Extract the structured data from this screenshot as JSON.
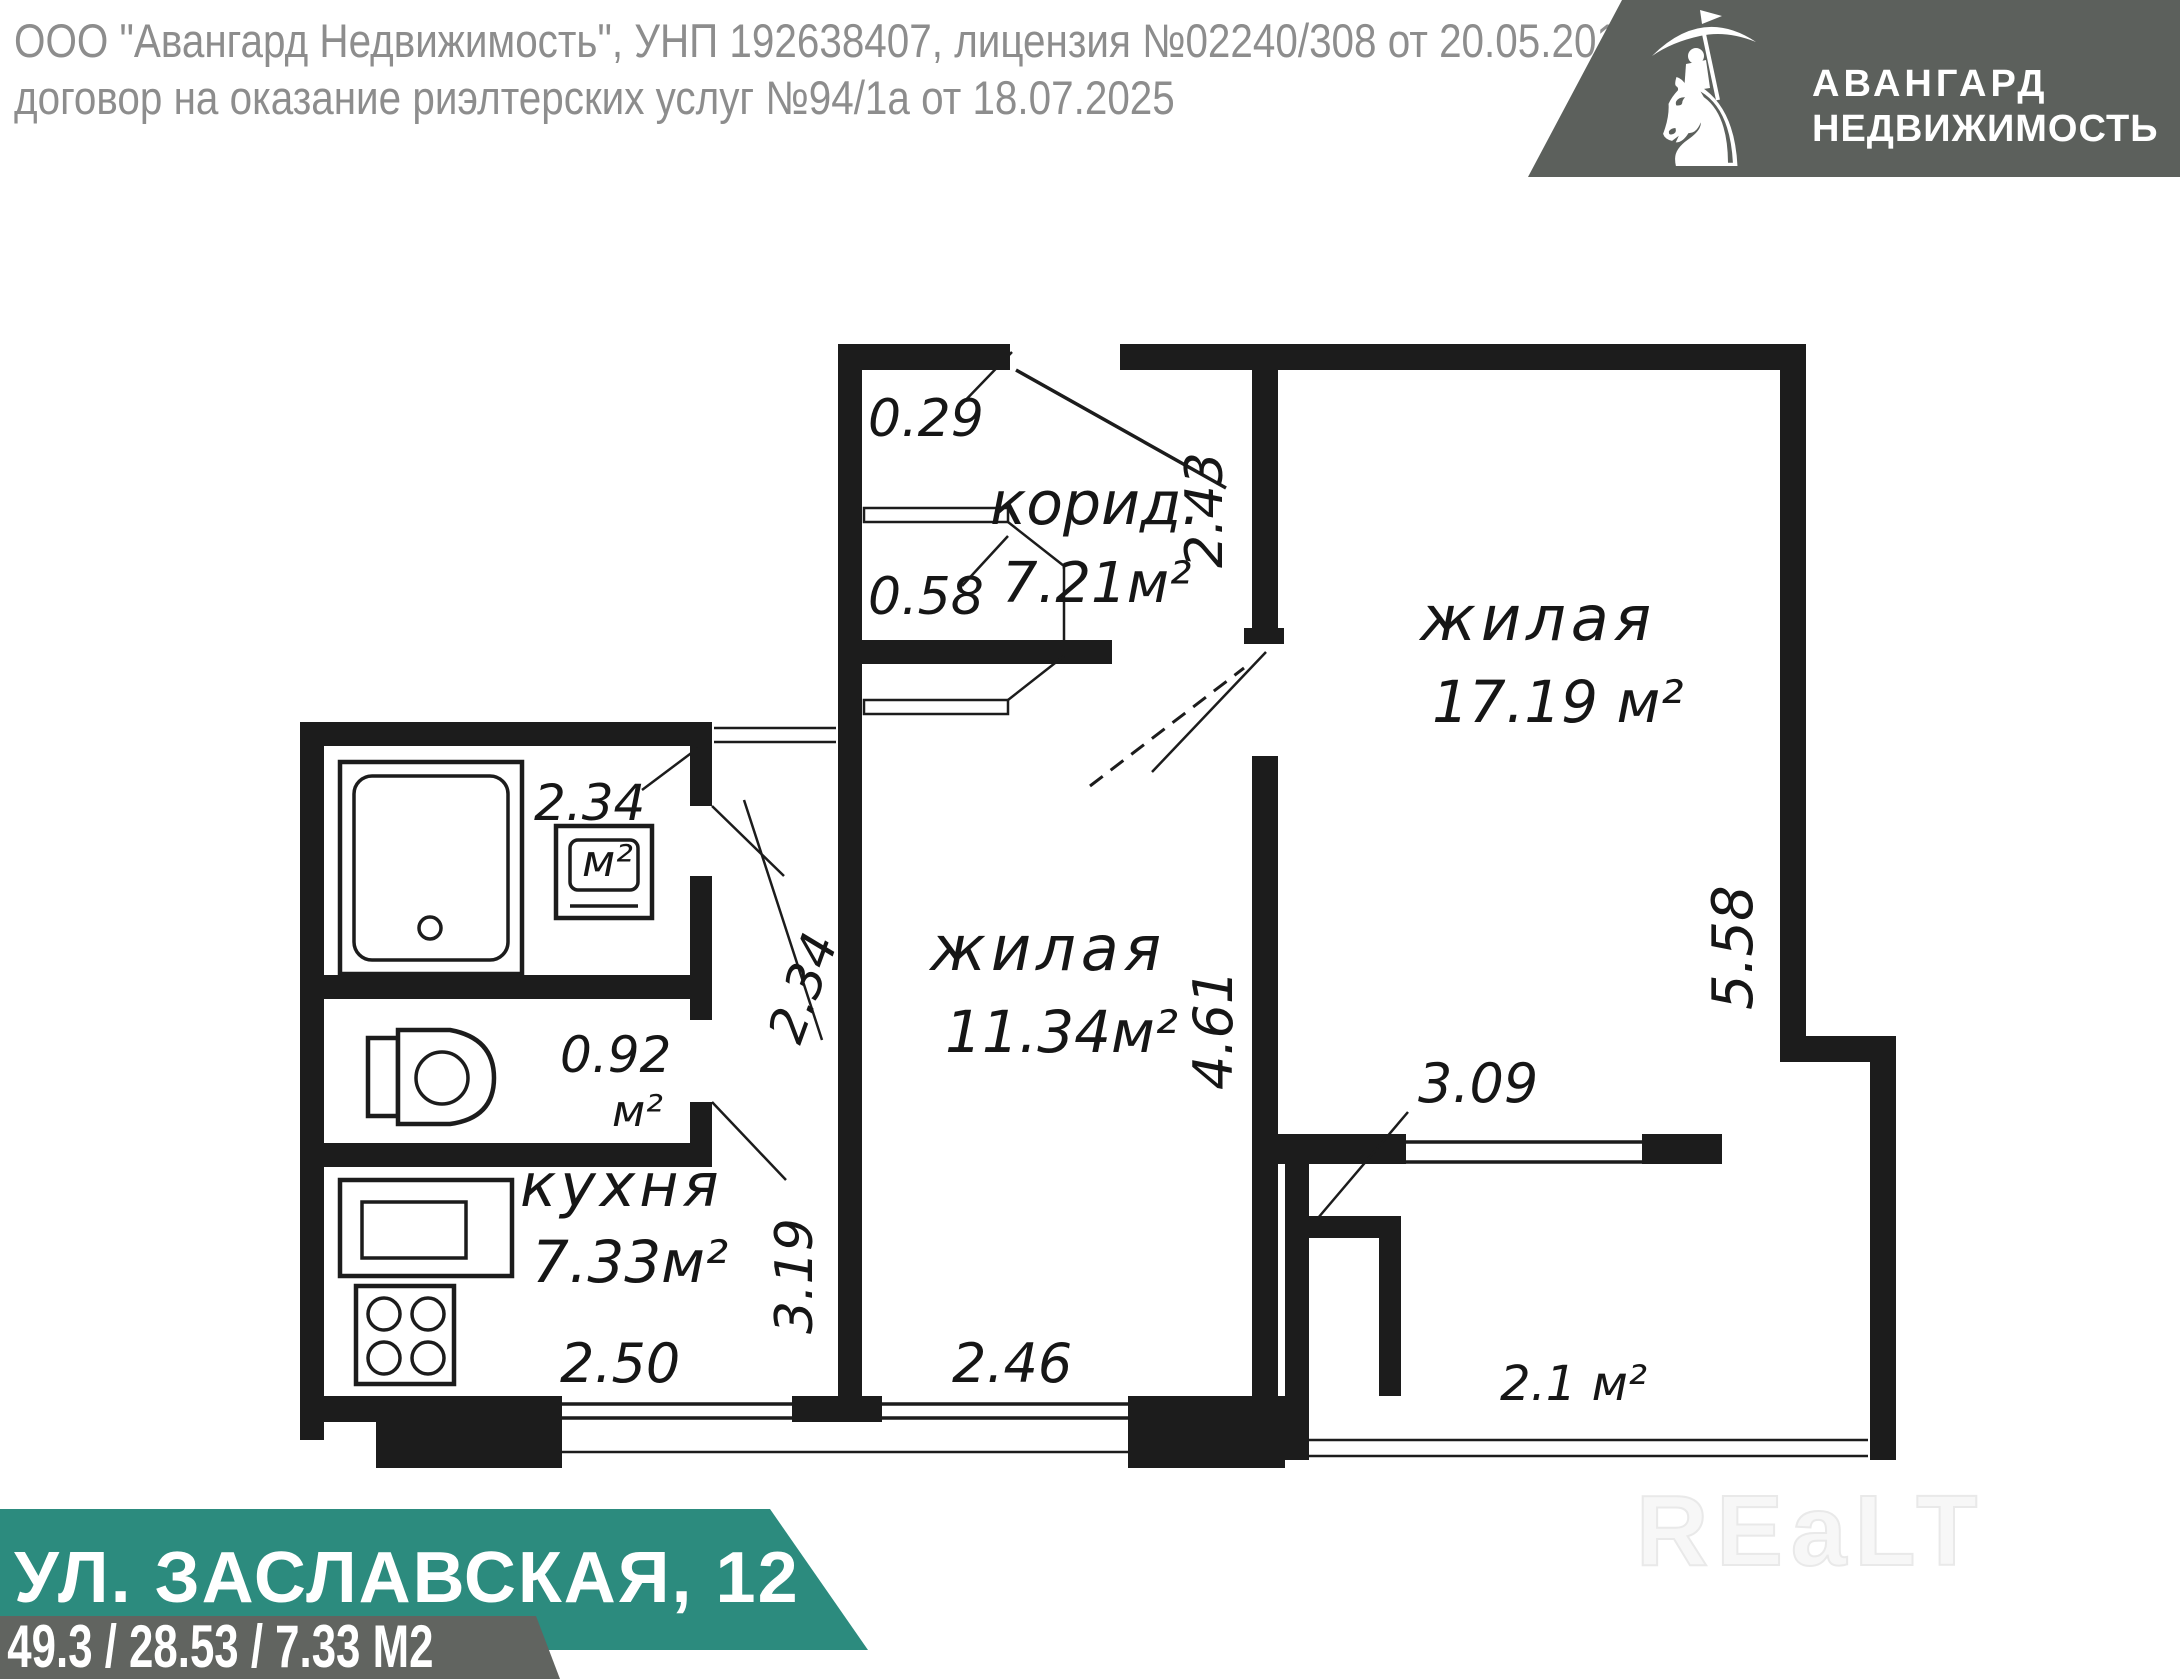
{
  "header": {
    "line1": "ООО \"Авангард Недвижимость\", УНП 192638407, лицензия №02240/308 от 20.05.2016,",
    "line2": "договор на оказание риэлтерских услуг №94/1а от 18.07.2025"
  },
  "logo": {
    "line1": "АВАНГАРД",
    "line2": "НЕДВИЖИМОСТЬ",
    "icon": "knight-on-horse-with-umbrella"
  },
  "plan": {
    "rooms": {
      "corridor": {
        "name": "корид.",
        "area": "7.21м²"
      },
      "living1": {
        "name": "жилая",
        "area": "17.19 м²"
      },
      "living2": {
        "name": "жилая",
        "area": "11.34м²"
      },
      "kitchen": {
        "name": "кухня",
        "area": "7.33м²"
      },
      "bath": {
        "area": "2.34",
        "unit": "м²"
      },
      "wc": {
        "area": "0.92",
        "unit": "м²"
      },
      "balcony": {
        "area": "2.1 м²"
      }
    },
    "dims": {
      "entry_niche": "0.29",
      "entry_closet": "0.58",
      "living1_top": "2.43",
      "hall_depth": "2.34",
      "living1_height": "5.58",
      "living2_height": "4.61",
      "kitchen_height": "3.19",
      "living1_width": "3.09",
      "kitchen_width": "2.50",
      "living2_width": "2.46"
    }
  },
  "footer": {
    "address": "УЛ. ЗАСЛАВСКАЯ, 12",
    "areas": "49.3 / 28.53 / 7.33 М2"
  },
  "watermark": "REaLT",
  "colors": {
    "teal": "#2c8b7e",
    "gray_band": "#616460",
    "logo_bg": "#5c605c",
    "header_text": "#8d8d8d",
    "plan_lines": "#1c1c1c"
  }
}
